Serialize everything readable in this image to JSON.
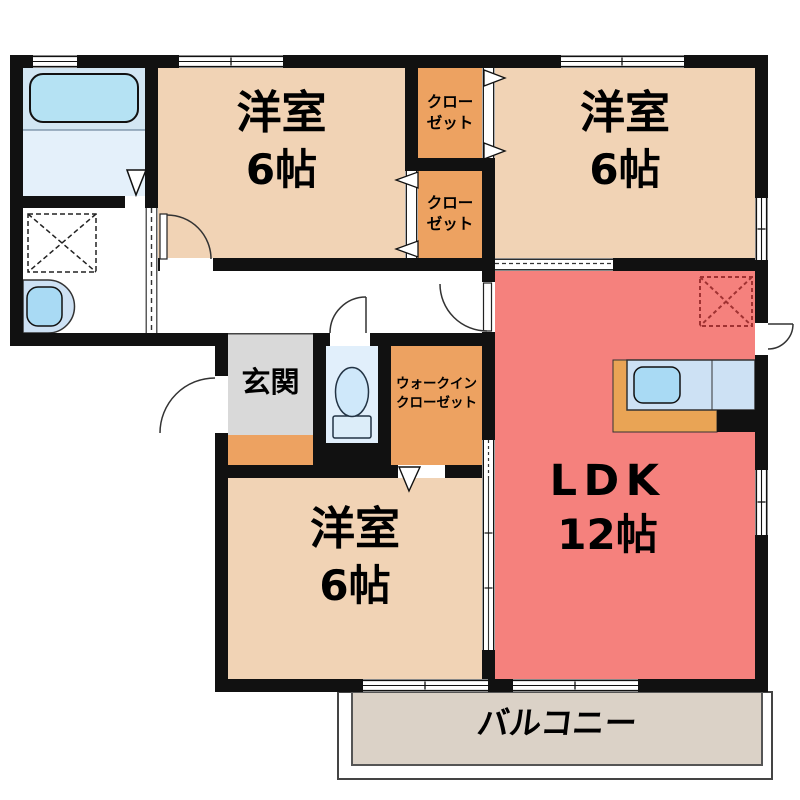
{
  "colors": {
    "wall": "#111111",
    "bedroom_floor": "#f1d3b5",
    "closet_floor": "#eda261",
    "ldk_floor": "#f5817d",
    "entrance_floor": "#d9d9d9",
    "toilet_floor": "#e1effb",
    "bath_floor_upper": "#d2e6f3",
    "bath_floor_lower": "#e4f0fa",
    "balcony_floor": "#dbd2c7",
    "fixture_light_blue": "#cde1f4",
    "fixture_blue": "#a9daf4",
    "tub_blue": "#b5e2f3",
    "tank_blue": "#dcedf9",
    "bowl_blue": "#cfe8fa",
    "counter_orange": "#e9a455",
    "fridge_dash": "#a03232"
  },
  "rooms": {
    "bedroom1": {
      "name": "洋室",
      "size": "6帖"
    },
    "bedroom2": {
      "name": "洋室",
      "size": "6帖"
    },
    "bedroom3": {
      "name": "洋室",
      "size": "6帖"
    },
    "ldk": {
      "name": "LDK",
      "size": "12帖"
    },
    "closet_top": {
      "line1": "クロー",
      "line2": "ゼット"
    },
    "closet_bottom": {
      "line1": "クロー",
      "line2": "ゼット"
    },
    "walk_in_closet": {
      "line1": "ウォークイン",
      "line2": "クローゼット"
    },
    "entrance": {
      "name": "玄関"
    },
    "balcony": {
      "name": "バルコニー"
    }
  }
}
